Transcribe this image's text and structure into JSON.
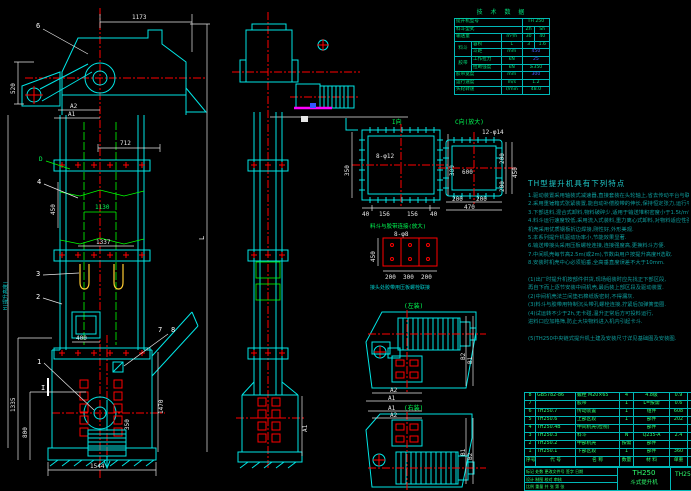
{
  "palette": {
    "background": "#000000",
    "line_cyan": "#00e5e5",
    "centerline_red": "#ff0000",
    "dim_white": "#e8e8e8",
    "text_green": "#2eff6e",
    "bucket_yellow": "#ffcc33",
    "accent_magenta": "#ff00ff",
    "spec_blue": "#4d5bff",
    "notes_teal": "#0e9c9c"
  },
  "spec": {
    "title": "技 术 数 据",
    "r1l": "提升机型号",
    "r1v": "TH 250",
    "r2l": "料斗型式",
    "r2a": "Zh",
    "r2b": "Sh",
    "r3l": "输送量",
    "r3u": "m³/h",
    "r3a": "30",
    "r3b": "40",
    "g1": "料斗",
    "r4l": "容积",
    "r4u": "L",
    "r4a": "3",
    "r4b": "1.6",
    "r5l": "斗距",
    "r5u": "mm",
    "r5v": "450",
    "g2": "胶带",
    "r6l": "工作拉力",
    "r6u": "kN",
    "r6v": "25",
    "r7l": "拉断强度",
    "r7u": "kN",
    "r7v": "≥350",
    "r8l": "胶带宽度",
    "r8u": "mm",
    "r8v": "300",
    "r9l": "运行速度",
    "r9u": "m/s",
    "r9v": "1.2",
    "r10l": "头轮转速",
    "r10u": "r/min",
    "r10v": "48.0"
  },
  "notes": {
    "title": "TH型提升机具有下列特点",
    "lines": [
      "1.驱动装置采用轴装式减速器,直接套装在头轮轴上,省去传动平台与联轴器,结构紧凑,重量轻,安装维修方便.",
      "2.采用重锤箱式张紧装置,能自动补偿胶带的伸长,保持恒定张力,运行平稳可靠,胶带不易跑偏.",
      "3.下部进料,混合式卸料,物料破碎少,适用于输送堆积密度小于1.5t/m³的粉状,粒状及小块状物料.",
      "4.料斗运行速度较低,采用流入式装料,重力离心式卸料,对物料适应性强,输送量大,提升高度高,密封性好,",
      "  机壳采用优质钢板折边焊接,刚性好,外形美观.",
      "5.本系列提升机驱动功率小,节能效果显著.",
      "6.输送带接头采用压板螺栓连接,连接强度高,更换料斗方便.",
      "7.中间机壳每节高2.5m(或2m),节数由用户按提升高度H选取.",
      "8.安装时机壳中心必须铅垂,全高垂直度误差不大于10mm.",
      "",
      "(1)出厂时提升机按部件供货,现场组装时应先找正下部区段,",
      "  再自下而上逐节安装中间机壳,最后装上部区段及驱动装置.",
      "(2)中间机壳法兰间垫石棉纸板密封,不得漏灰.",
      "(3)料斗与胶带用特制沉头带孔螺栓连接,拧紧后加弹簧垫圈.",
      "(4)试运转不少于2h,无卡碰,温升正常后方可投料运行,",
      "  进料口应加格筛,防止大块物料进入机内引起卡斗.",
      "",
      "(5)TH250中央链式提升机土建及安装尺寸详见基础图及安装图."
    ]
  },
  "bom": {
    "headers": [
      "序号",
      "代  号",
      "名  称",
      "数量",
      "材  料",
      "单重",
      "备注"
    ],
    "rows": [
      [
        "8",
        "GB5782-86",
        "螺栓 M20×65",
        "4",
        "4.8级",
        "0.9",
        ""
      ],
      [
        "7",
        "",
        "胶带",
        "1",
        "L=按需",
        "0.6",
        ""
      ],
      [
        "6",
        "TH250.7",
        "传动装置",
        "1",
        "组件",
        "608",
        ""
      ],
      [
        "5",
        "TH250.6",
        "上部区段",
        "1",
        "部件",
        "202",
        ""
      ],
      [
        "4",
        "TH250.4B",
        "中间机壳(检视)",
        "",
        "部件",
        "",
        ""
      ],
      [
        "3",
        "TH250.3",
        "料斗",
        "N",
        "Q235-A",
        "2.4",
        ""
      ],
      [
        "2",
        "TH250.2",
        "中部机壳",
        "按需",
        "部件",
        "",
        ""
      ],
      [
        "1",
        "TH250.1",
        "下部区段",
        "1",
        "部件",
        "360",
        ""
      ]
    ]
  },
  "title_block": {
    "model": "TH250",
    "product": "斗式提升机",
    "drawing_no": "TH250.0",
    "sig_row1": "标记 处数 更改文件号 签字 日期",
    "sig_row2": "设计  制图  校对  审核",
    "sig_row3": "比例    重量    共 张 第 张"
  },
  "left_view": {
    "dims": {
      "top_width": "1173",
      "motor_height": "520",
      "a2": "A2",
      "a1": "A1",
      "mid_width": "712",
      "flange_height": "450",
      "pitch": "1130",
      "inner_width": "1337",
      "inlet_width": "400",
      "boot_right": "1470",
      "wrap": "350",
      "takeup": "1335",
      "weight": "800",
      "base_width": "1544",
      "total_left": "H(提升高度)",
      "total_right": "L"
    },
    "callouts": {
      "c1": "1",
      "c2": "2",
      "c3": "3",
      "c4": "4",
      "c6": "6",
      "c7": "7",
      "c8": "8",
      "d": "D",
      "section": "I"
    }
  },
  "middle_view": {
    "dims": {
      "a1": "A1"
    }
  },
  "details": {
    "i_view": {
      "title": "I向",
      "left": "350",
      "right": "300",
      "seg1": "40",
      "seg2": "156",
      "seg3": "156",
      "seg4": "40",
      "holes": "8-φ12"
    },
    "c_view": {
      "title": "C向(放大)",
      "holes": "12-φ14",
      "inner": "600",
      "r1": "200",
      "r2": "200",
      "rtotal": "450",
      "b1": "200",
      "b2": "200",
      "btotal": "470"
    },
    "belt_joint": {
      "title": "料斗与胶带连接(放大)",
      "holes": "8-φ8",
      "left": "450",
      "b1": "200",
      "b2": "300",
      "b3": "200",
      "note": "接头处胶带用压板螺栓联接"
    },
    "plan_left": {
      "title": "(左装)",
      "a1": "A1",
      "a2": "A2",
      "b1": "B1",
      "b2": "B2"
    },
    "plan_right": {
      "title": "(右装)",
      "a1": "A1",
      "a2": "A2",
      "b1": "B1",
      "b2": "B2"
    }
  }
}
